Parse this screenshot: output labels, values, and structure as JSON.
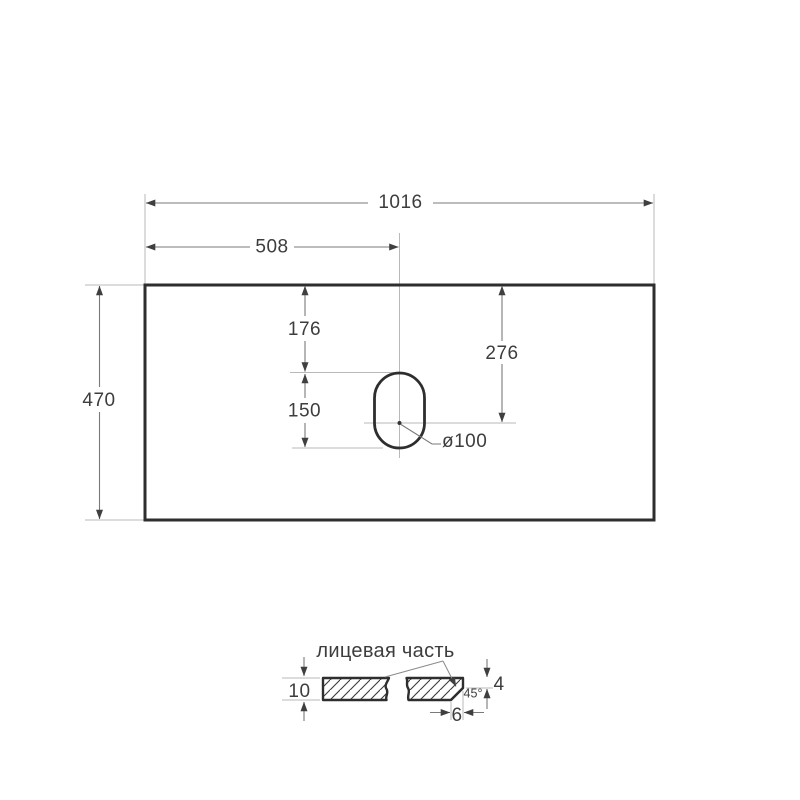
{
  "drawing": {
    "top_view": {
      "overall_width": "1016",
      "hole_center_from_left": "508",
      "overall_depth": "470",
      "hole_top_offset": "176",
      "hole_length": "150",
      "hole_center_from_front": "276",
      "hole_diameter": "ø100"
    },
    "section_view": {
      "face_label": "лицевая часть",
      "thickness": "10",
      "edge_flat_height": "4",
      "chamfer_angle": "45°",
      "chamfer_width": "6"
    },
    "colors": {
      "background": "#ffffff",
      "outline": "#2e2e2e",
      "dimension_line": "#7a7a7a",
      "extension_line": "#b9b9b9",
      "arrow": "#3f3f3f",
      "text": "#3d3d3d"
    }
  }
}
